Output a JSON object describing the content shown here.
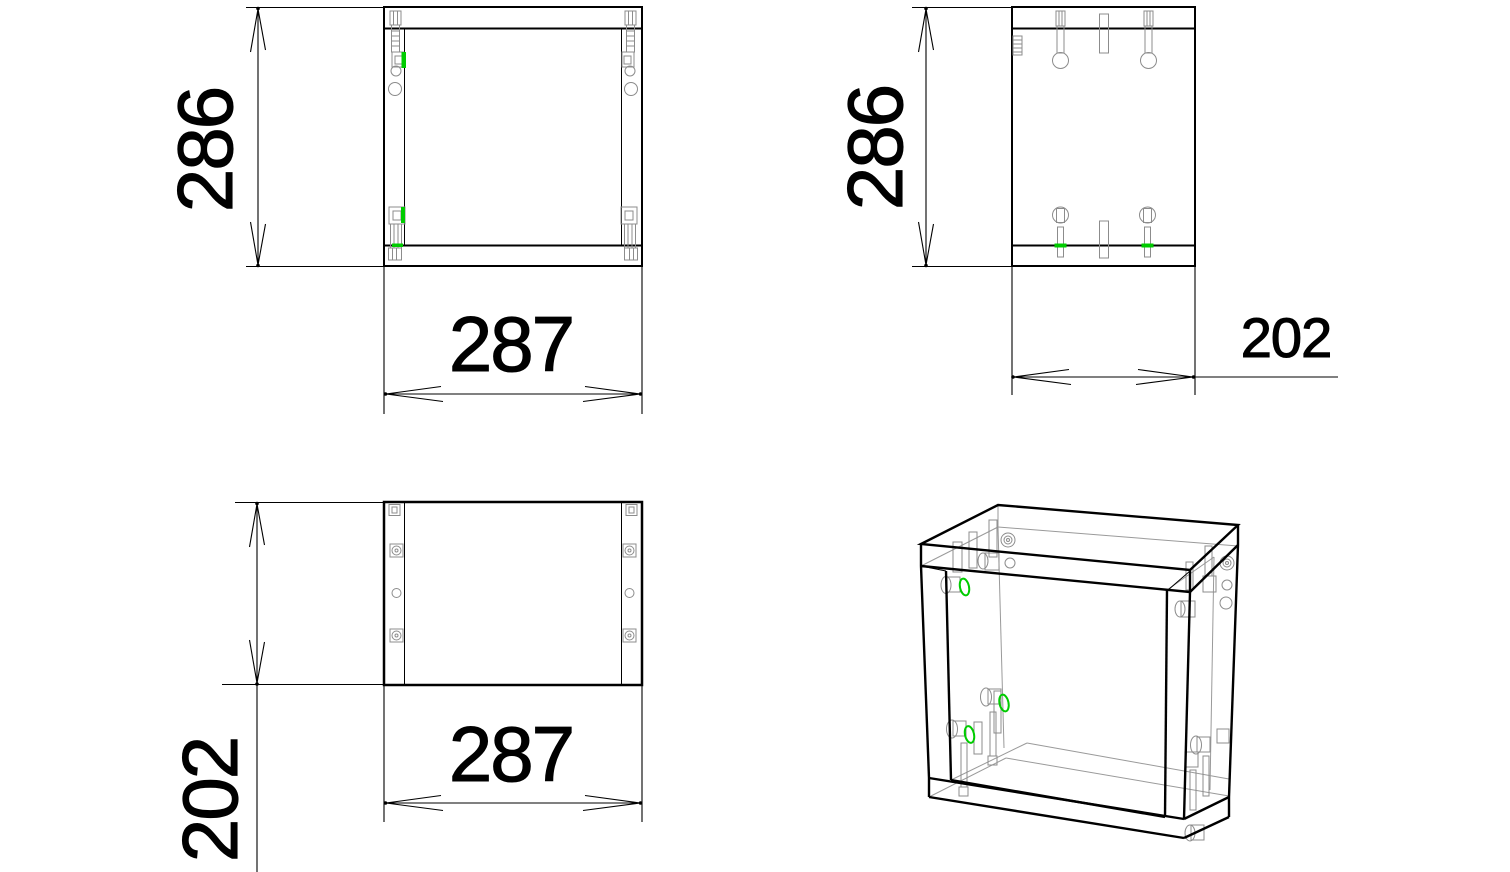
{
  "drawing": {
    "colors": {
      "background": "#ffffff",
      "line": "#000000",
      "hardware": "#8c8c8c",
      "highlight": "#00cc00"
    },
    "views": {
      "front": {
        "dim_height": "286",
        "dim_width": "287"
      },
      "side": {
        "dim_height": "286",
        "dim_depth": "202"
      },
      "top": {
        "dim_width": "287",
        "dim_depth": "202"
      }
    }
  }
}
